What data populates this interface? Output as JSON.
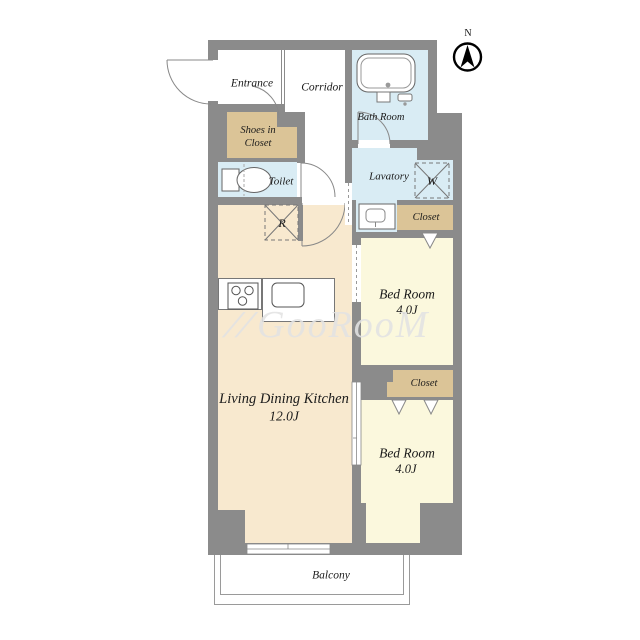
{
  "plan": {
    "type": "apartment-floor-plan",
    "compass": {
      "north_label": "N"
    },
    "watermark": {
      "mark": "//",
      "text": "GooRooM"
    },
    "rooms": {
      "entrance": {
        "label": "Entrance"
      },
      "corridor": {
        "label": "Corridor"
      },
      "bath_room": {
        "label": "Bath Room"
      },
      "shoes_in_closet": {
        "line1": "Shoes in",
        "line2": "Closet"
      },
      "toilet": {
        "label": "Toilet"
      },
      "lavatory": {
        "label": "Lavatory"
      },
      "closet_upper": {
        "label": "Closet"
      },
      "closet_lower": {
        "label": "Closet"
      },
      "bedroom_upper": {
        "label": "Bed Room",
        "size": "4.0J"
      },
      "bedroom_lower": {
        "label": "Bed Room",
        "size": "4.0J"
      },
      "ldk": {
        "label": "Living Dining Kitchen",
        "size": "12.0J"
      },
      "balcony": {
        "label": "Balcony"
      }
    },
    "symbols": {
      "washing_machine": "W",
      "refrigerator": "R"
    },
    "colors": {
      "wall": "#8b8b8b",
      "ldk": "#f8e9cf",
      "bedroom": "#fbf8dd",
      "wet": "#d9ecf4",
      "closet": "#dbc497",
      "outline": "#777777"
    }
  }
}
